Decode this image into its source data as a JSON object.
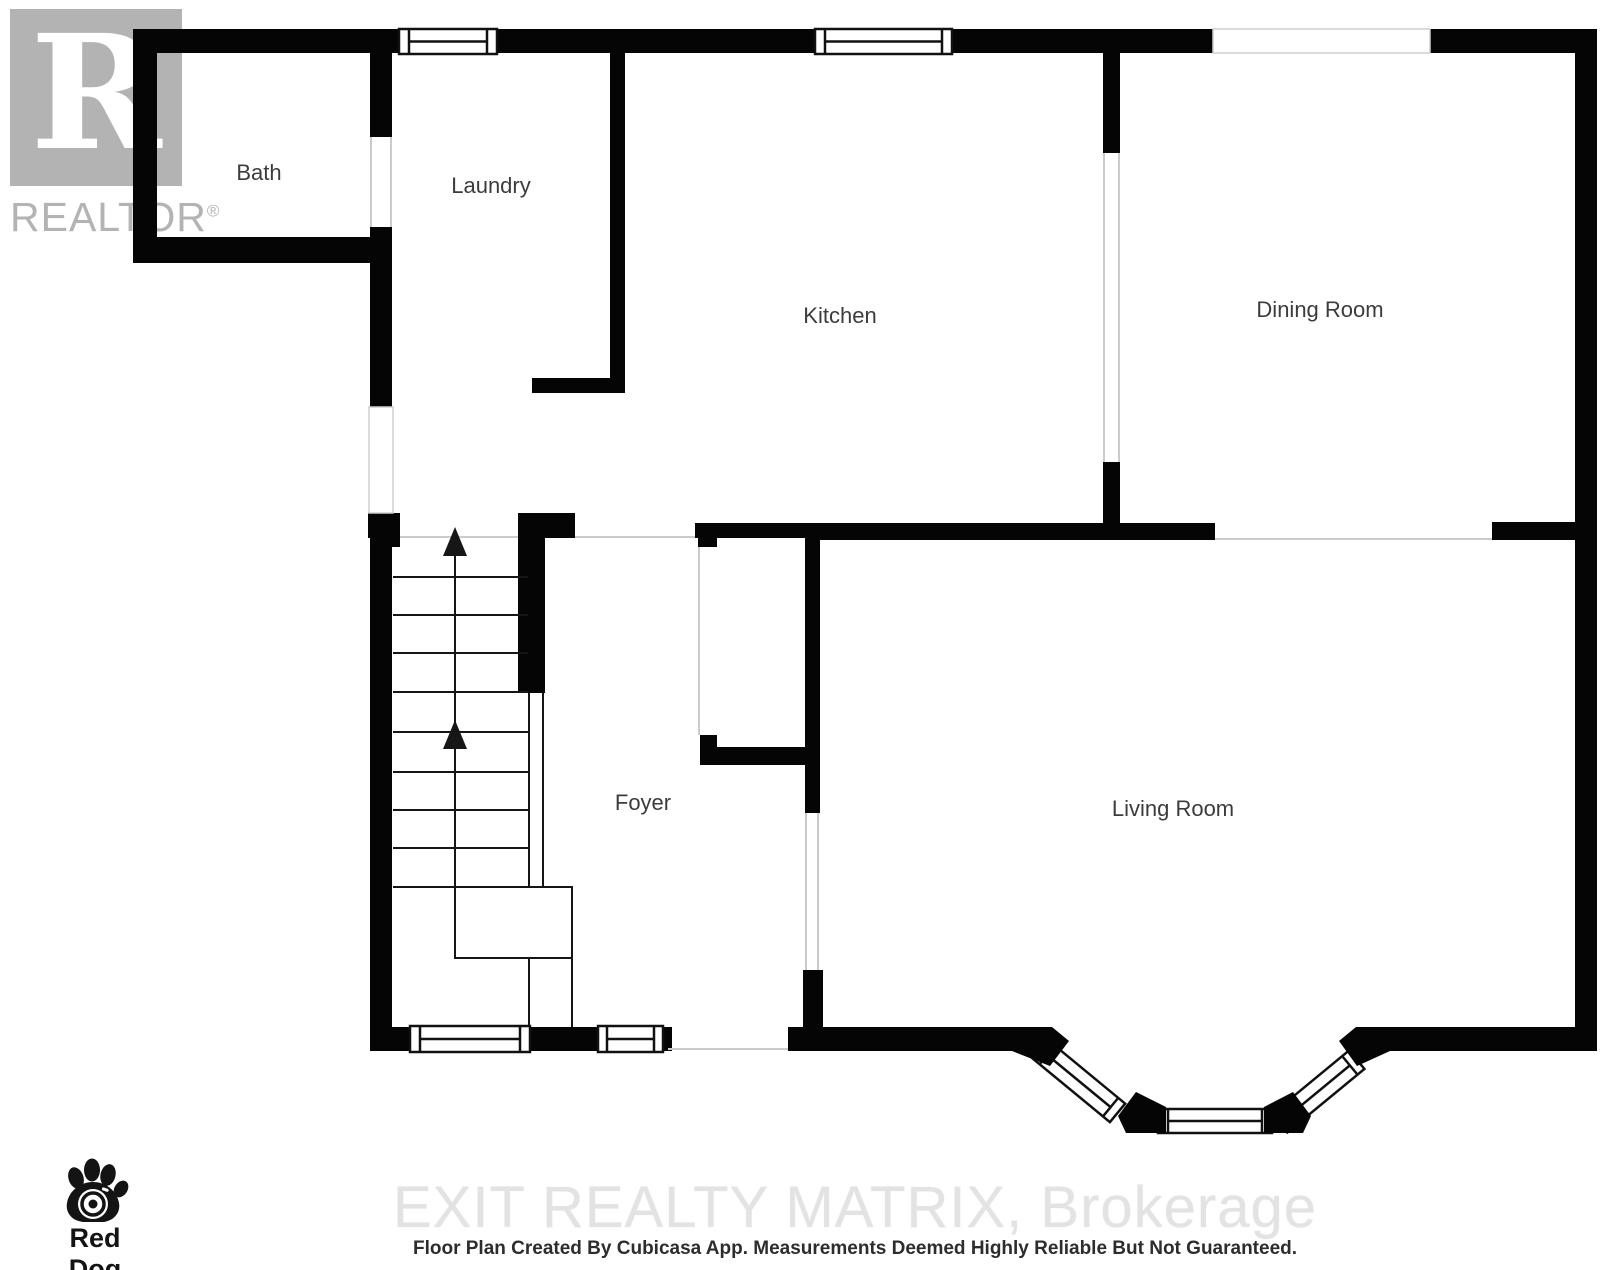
{
  "page": {
    "background": "#ffffff"
  },
  "branding": {
    "realtor": {
      "letter": "R",
      "wordmark": "REALTOR",
      "registered": "®"
    },
    "red_dog": {
      "name": "Red Dog",
      "tagline": "DIGITAL"
    },
    "watermark": "EXIT REALTY MATRIX, Brokerage",
    "caption": "Floor Plan Created By Cubicasa App. Measurements Deemed Highly Reliable But Not Guaranteed."
  },
  "floorplan": {
    "rooms": [
      {
        "id": "bath",
        "label": "Bath"
      },
      {
        "id": "laundry",
        "label": "Laundry"
      },
      {
        "id": "kitchen",
        "label": "Kitchen"
      },
      {
        "id": "dining-room",
        "label": "Dining Room"
      },
      {
        "id": "foyer",
        "label": "Foyer"
      },
      {
        "id": "living-room",
        "label": "Living Room"
      }
    ],
    "stairs": {
      "direction": "up",
      "flights": 2
    },
    "colors": {
      "wall": "#050505",
      "opening_line": "#cbcbcb",
      "stair_line": "#161616",
      "label_text": "#3c3c3c",
      "watermark_text": "#e3e3e3",
      "logo_gray": "#b3b3b3"
    }
  }
}
